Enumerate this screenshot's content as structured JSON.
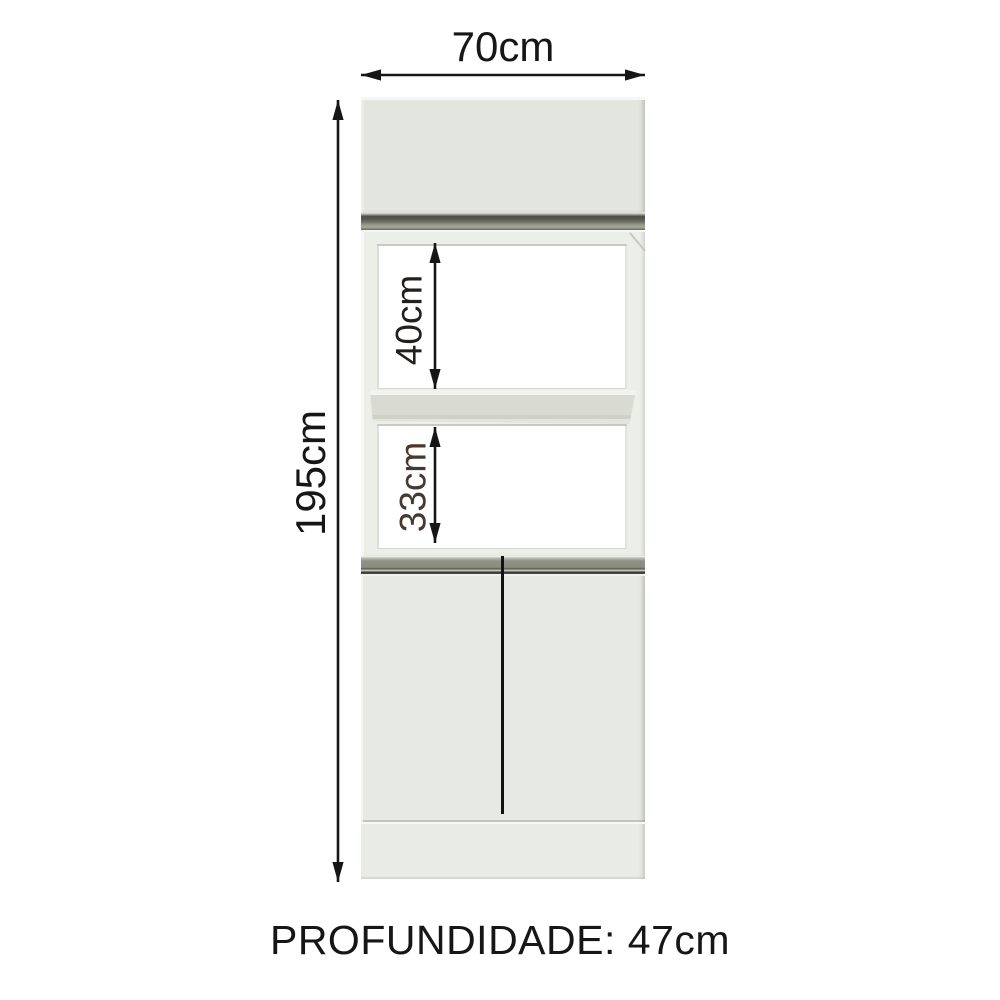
{
  "diagram": {
    "kind": "furniture-dimension-diagram",
    "labels": {
      "width": "70cm",
      "height": "195cm",
      "upper_niche": "40cm",
      "lower_niche": "33cm",
      "depth": "PROFUNDIDADE: 47cm"
    },
    "dimensions_cm": {
      "width": 70,
      "height": 195,
      "upper_niche_opening": 40,
      "lower_niche_opening": 33,
      "depth": 47
    }
  },
  "colors": {
    "page": "#ffffff",
    "dimension": "#161616",
    "upper_label": "#221f1d",
    "lower_label": "#46392f",
    "door_panel": "#e3e5df",
    "doors": "#e7e9e3",
    "base": "#e9ebe5",
    "frame": "#eceee8",
    "opening": "#ffffff",
    "shelf": "#d9dbd3",
    "profile_dark": "#4c4e46",
    "profile_light": "#9b9d8f",
    "handle": "#8f9186",
    "edge_line": "#3a3c34"
  }
}
